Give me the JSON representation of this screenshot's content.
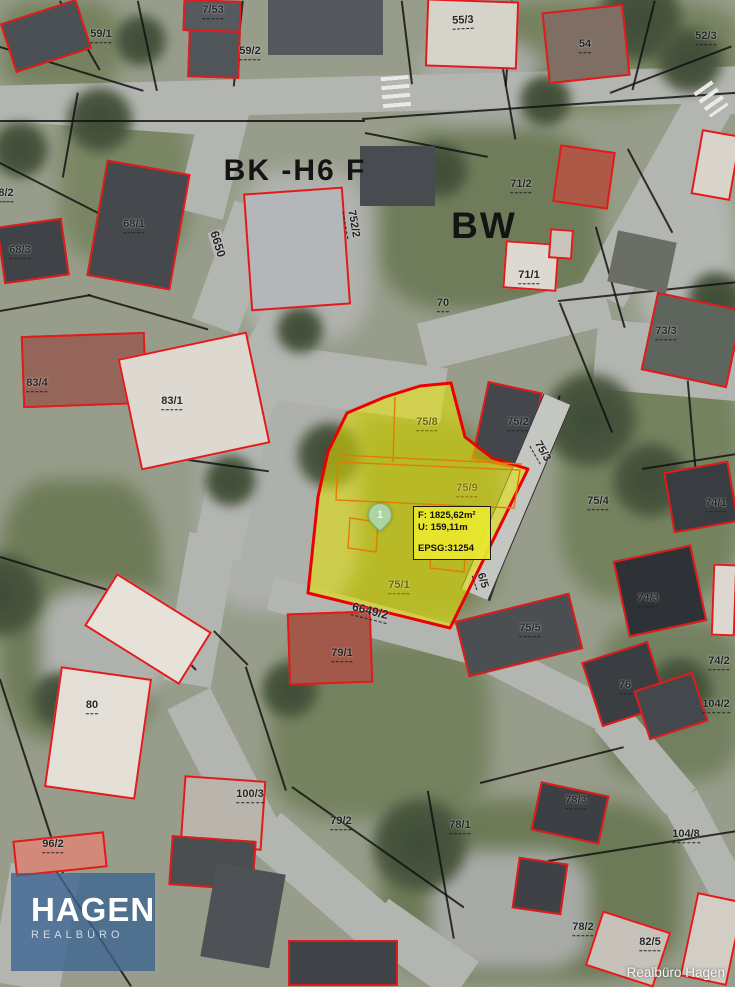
{
  "map": {
    "labels": [
      {
        "text": "59/1",
        "x": 101,
        "y": 36
      },
      {
        "text": "7/53",
        "x": 213,
        "y": 12
      },
      {
        "text": "59/2",
        "x": 250,
        "y": 53
      },
      {
        "text": "55/3",
        "x": 463,
        "y": 22,
        "rot": -3
      },
      {
        "text": "54",
        "x": 585,
        "y": 46
      },
      {
        "text": "52/3",
        "x": 706,
        "y": 38
      },
      {
        "text": "BK -H6 F",
        "x": 295,
        "y": 171,
        "kind": "zone",
        "size": 30
      },
      {
        "text": "BW",
        "x": 484,
        "y": 226,
        "kind": "zone",
        "size": 37
      },
      {
        "text": "68/1",
        "x": 134,
        "y": 226
      },
      {
        "text": "68/3",
        "x": 20,
        "y": 252
      },
      {
        "text": "8/2",
        "x": 6,
        "y": 195
      },
      {
        "text": "6650",
        "x": 218,
        "y": 244,
        "rot": 73,
        "kind": "road",
        "size": 12
      },
      {
        "text": "752/2",
        "x": 352,
        "y": 224,
        "rot": 80
      },
      {
        "text": "71/2",
        "x": 521,
        "y": 186
      },
      {
        "text": "71/1",
        "x": 529,
        "y": 277
      },
      {
        "text": "70",
        "x": 443,
        "y": 305
      },
      {
        "text": "73/3",
        "x": 666,
        "y": 333
      },
      {
        "text": "83/4",
        "x": 37,
        "y": 385
      },
      {
        "text": "83/1",
        "x": 172,
        "y": 403
      },
      {
        "text": "75/8",
        "x": 427,
        "y": 424,
        "color": "#6e6a00"
      },
      {
        "text": "75/2",
        "x": 518,
        "y": 424
      },
      {
        "text": "75/3",
        "x": 541,
        "y": 452,
        "rot": 60
      },
      {
        "text": "75/9",
        "x": 467,
        "y": 490,
        "color": "#8a7400"
      },
      {
        "text": "75/4",
        "x": 598,
        "y": 503
      },
      {
        "text": "74/1",
        "x": 716,
        "y": 505
      },
      {
        "text": "74/3",
        "x": 648,
        "y": 600
      },
      {
        "text": "75/1",
        "x": 399,
        "y": 587,
        "color": "#6e6a00"
      },
      {
        "text": "6649/2",
        "x": 370,
        "y": 612,
        "rot": 14,
        "size": 12
      },
      {
        "text": "6/5",
        "x": 481,
        "y": 581,
        "rot": 72
      },
      {
        "text": "75/5",
        "x": 530,
        "y": 630
      },
      {
        "text": "79/1",
        "x": 342,
        "y": 655
      },
      {
        "text": "76",
        "x": 625,
        "y": 687
      },
      {
        "text": "74/2",
        "x": 719,
        "y": 663
      },
      {
        "text": "104/2",
        "x": 716,
        "y": 706
      },
      {
        "text": "80",
        "x": 92,
        "y": 707
      },
      {
        "text": "100/3",
        "x": 250,
        "y": 796
      },
      {
        "text": "79/2",
        "x": 341,
        "y": 823
      },
      {
        "text": "78/1",
        "x": 460,
        "y": 827
      },
      {
        "text": "78/3",
        "x": 576,
        "y": 802
      },
      {
        "text": "104/8",
        "x": 686,
        "y": 836
      },
      {
        "text": "96/2",
        "x": 53,
        "y": 846
      },
      {
        "text": "78/2",
        "x": 583,
        "y": 929
      },
      {
        "text": "82/5",
        "x": 650,
        "y": 944
      }
    ],
    "highlight": {
      "marker": {
        "label": "1"
      },
      "info_box": {
        "area": "F: 1825,62m²",
        "perimeter": "U: 159,11m",
        "epsg": "EPSG:31254"
      }
    },
    "watermark": {
      "title": "HAGEN",
      "subtitle": "REALBÜRO"
    },
    "attribution": "Realbüro Hagen",
    "colors": {
      "parcel_outline": "#e31a1a",
      "highlight_fill": "#e6e300",
      "highlight_outline": "#ee0000",
      "subparcel_line": "#e07d00",
      "boundary_line": "#1a1a1a",
      "info_box_background": "#eae72e",
      "marker_fill": "#abd5a2",
      "logo_background": "#3c6492"
    }
  }
}
